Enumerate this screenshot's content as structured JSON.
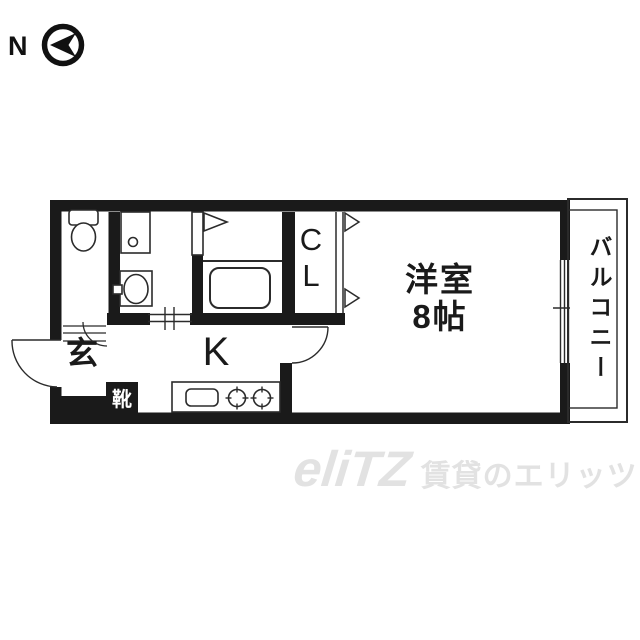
{
  "compass": {
    "label": "N"
  },
  "floor_plan": {
    "rooms": {
      "western_room": {
        "label": "洋室\n8帖"
      },
      "kitchen": {
        "label": "K"
      },
      "closet": {
        "label": "C\nL"
      },
      "entrance": {
        "label": "玄"
      },
      "shoe_cabinet": {
        "label": "靴"
      },
      "balcony": {
        "label": "バルコニー"
      }
    }
  },
  "watermark": {
    "logo": "eliTZ",
    "text": "賃貸のエリッツ"
  },
  "colors": {
    "wall": "#1a1a1a",
    "fixture_line": "#2b2b2b",
    "watermark": "#e2e2e2",
    "background": "#ffffff"
  }
}
